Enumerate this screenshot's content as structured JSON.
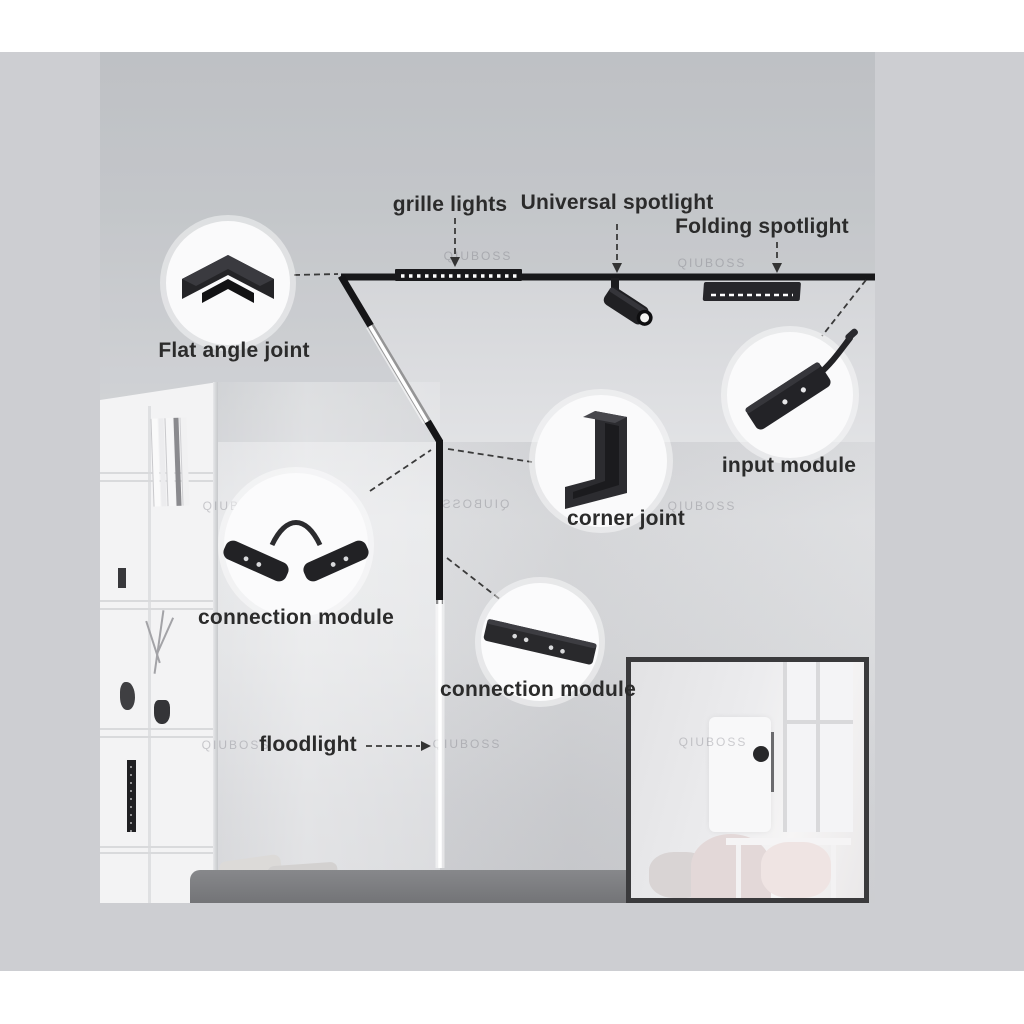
{
  "page": {
    "background": "#ffffff",
    "canvas_color": "#cdced2"
  },
  "diagram": {
    "watermark": "QIUBOSS",
    "colors": {
      "track": "#18181a",
      "led_strip": "#ffffff",
      "label_text": "#2b2b2b",
      "callout_circle": "#fafafb",
      "connector_line": "#3a3a3a"
    },
    "annotations": [
      {
        "id": "grille-lights",
        "label": "grille lights",
        "icon": "grille-light-bar-icon"
      },
      {
        "id": "universal-spotlight",
        "label": "Universal spotlight",
        "icon": "cylinder-spotlight-icon"
      },
      {
        "id": "folding-spotlight",
        "label": "Folding spotlight",
        "icon": "folding-panel-icon"
      },
      {
        "id": "flat-angle-joint",
        "label": "Flat angle joint",
        "icon": "flat-angle-joint-icon"
      },
      {
        "id": "input-module",
        "label": "input module",
        "icon": "input-module-icon"
      },
      {
        "id": "corner-joint",
        "label": "corner joint",
        "icon": "corner-joint-icon"
      },
      {
        "id": "connection-module-a",
        "label": "connection module",
        "icon": "flex-connection-module-icon"
      },
      {
        "id": "connection-module-b",
        "label": "connection module",
        "icon": "straight-connection-module-icon"
      },
      {
        "id": "floodlight",
        "label": "floodlight",
        "icon": "led-strip-icon"
      }
    ]
  }
}
